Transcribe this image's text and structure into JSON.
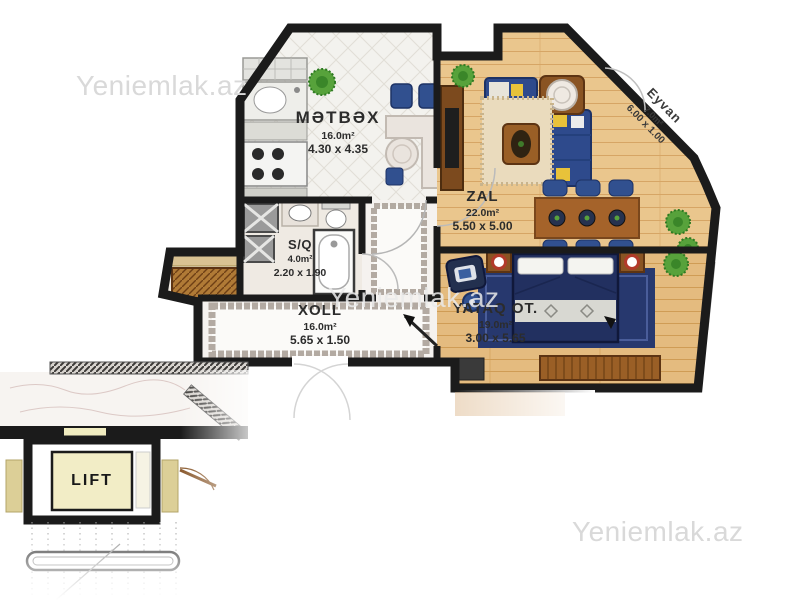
{
  "watermarks": {
    "top_left": "Yeniemlak.az",
    "center": "Yeniemlak.az",
    "bottom_right": "Yeniemlak.az"
  },
  "rooms": {
    "kitchen": {
      "name": "MƏTBƏX",
      "area": "16.0m²",
      "dimensions": "4.30 x 4.35"
    },
    "living_room": {
      "name": "ZAL",
      "area": "22.0m²",
      "dimensions": "5.50 x 5.00"
    },
    "bathroom": {
      "name": "S/Q",
      "area": "4.0m²",
      "dimensions": "2.20 x 1.90"
    },
    "hall": {
      "name": "XOLL",
      "area": "16.0m²",
      "dimensions": "5.65 x 1.50"
    },
    "bedroom": {
      "name": "YATAQ OT.",
      "area": "19.0m²",
      "dimensions": "3.00 x 5.65"
    },
    "balcony": {
      "name": "Eyvan",
      "area": "7.0m²",
      "dimensions": "6.00 x 1.00"
    }
  },
  "elevator": {
    "label": "LIFT"
  },
  "colors": {
    "wall": "#1b1b1b",
    "wood_floor": "#eac68d",
    "tile_floor": "#f3f2ee",
    "marble_floor": "#f5f2ef",
    "navy_furniture": "#2e4a8c",
    "bed_navy": "#223060",
    "accent_yellow": "#e8c23a",
    "lift_cream": "#f2edc6",
    "plant_green": "#57a23b",
    "watermark_gray": "#d9d9d9"
  }
}
